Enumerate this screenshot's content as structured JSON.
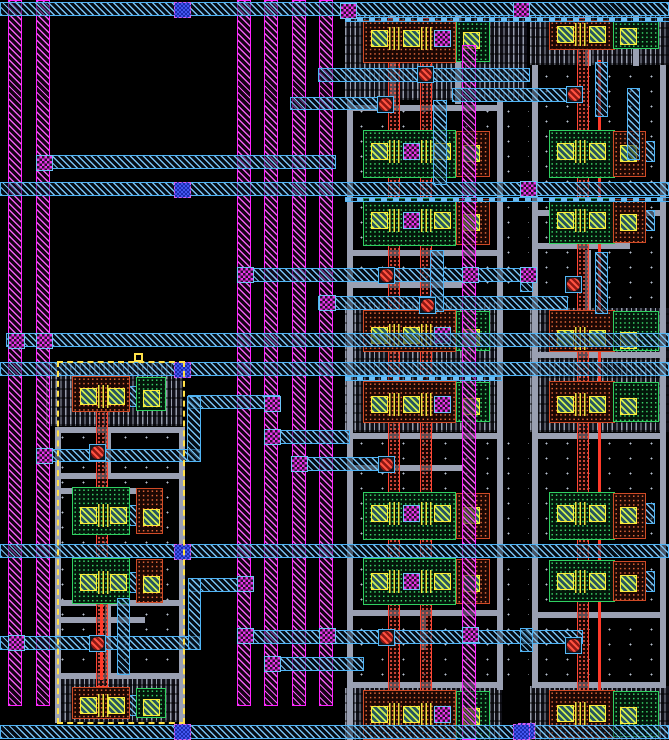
{
  "meta": {
    "width": 669,
    "height": 740,
    "description": "VLSI mask layout canvas (Magic-style), no visible text"
  },
  "palette": {
    "background": "#000000",
    "metal2": "#ff22ff",
    "metal1": "#4fb3f4",
    "via12": "#e835e8",
    "via23": "#4256ee",
    "pdiff": "#cf4a26",
    "ndiff": "#2fd061",
    "contact": "#ffe93c",
    "poly": "#ff3a2a",
    "li_wire": "#9aa0b2",
    "well_hatch": "#969cab",
    "selection": "#ffe14a"
  },
  "layout": {
    "substrate": [
      [
        345,
        100,
        184,
        82
      ],
      [
        530,
        65,
        139,
        117
      ],
      [
        345,
        196,
        184,
        106
      ],
      [
        530,
        196,
        139,
        106
      ],
      [
        345,
        432,
        184,
        112
      ],
      [
        530,
        432,
        139,
        112
      ],
      [
        345,
        558,
        184,
        130
      ],
      [
        530,
        558,
        139,
        128
      ],
      [
        46,
        426,
        137,
        118
      ],
      [
        46,
        558,
        137,
        115
      ]
    ],
    "wells": [
      [
        345,
        16,
        182,
        84
      ],
      [
        530,
        16,
        139,
        49
      ],
      [
        345,
        302,
        157,
        130
      ],
      [
        530,
        308,
        139,
        124
      ],
      [
        345,
        688,
        157,
        52
      ],
      [
        530,
        686,
        139,
        54
      ],
      [
        46,
        362,
        137,
        64
      ],
      [
        55,
        673,
        130,
        49
      ]
    ],
    "li_wires": [
      [
        347,
        100,
        6,
        640
      ],
      [
        497,
        100,
        6,
        590
      ],
      [
        347,
        105,
        156,
        6
      ],
      [
        347,
        250,
        156,
        6
      ],
      [
        353,
        282,
        110,
        6
      ],
      [
        347,
        433,
        156,
        6
      ],
      [
        353,
        465,
        110,
        6
      ],
      [
        347,
        610,
        156,
        6
      ],
      [
        347,
        682,
        156,
        6
      ],
      [
        390,
        16,
        6,
        88
      ],
      [
        455,
        16,
        6,
        88
      ],
      [
        420,
        610,
        6,
        40
      ],
      [
        532,
        65,
        6,
        620
      ],
      [
        660,
        65,
        6,
        621
      ],
      [
        532,
        210,
        134,
        6
      ],
      [
        538,
        243,
        92,
        6
      ],
      [
        532,
        352,
        134,
        6
      ],
      [
        532,
        433,
        134,
        6
      ],
      [
        532,
        612,
        134,
        6
      ],
      [
        532,
        682,
        134,
        6
      ],
      [
        585,
        16,
        6,
        50
      ],
      [
        633,
        16,
        6,
        50
      ],
      [
        585,
        250,
        6,
        60
      ],
      [
        55,
        427,
        6,
        296
      ],
      [
        179,
        427,
        6,
        296
      ],
      [
        55,
        427,
        130,
        6
      ],
      [
        55,
        473,
        124,
        6
      ],
      [
        61,
        488,
        80,
        6
      ],
      [
        55,
        600,
        130,
        6
      ],
      [
        61,
        617,
        84,
        6
      ],
      [
        55,
        673,
        130,
        6
      ],
      [
        105,
        598,
        6,
        77
      ],
      [
        105,
        433,
        6,
        42
      ]
    ],
    "poly_bars": [
      [
        388,
        18,
        12,
        688
      ],
      [
        420,
        18,
        12,
        688
      ],
      [
        577,
        18,
        12,
        688
      ],
      [
        96,
        375,
        12,
        312
      ]
    ],
    "poly_lines": [
      [
        598,
        60,
        3,
        640
      ],
      [
        100,
        560,
        3,
        120
      ]
    ],
    "m2_stripes": [
      [
        8,
        0,
        14,
        706
      ],
      [
        36,
        0,
        14,
        706
      ],
      [
        237,
        0,
        14,
        706
      ],
      [
        264,
        0,
        14,
        706
      ],
      [
        292,
        0,
        14,
        706
      ],
      [
        319,
        0,
        14,
        706
      ],
      [
        462,
        45,
        14,
        695
      ]
    ],
    "m1_h": [
      [
        0,
        2,
        669,
        14
      ],
      [
        0,
        182,
        669,
        14
      ],
      [
        0,
        362,
        669,
        14
      ],
      [
        0,
        544,
        669,
        14
      ],
      [
        0,
        725,
        669,
        14
      ],
      [
        36,
        155,
        300,
        14
      ],
      [
        318,
        68,
        212,
        14
      ],
      [
        452,
        88,
        116,
        14
      ],
      [
        290,
        97,
        90,
        13
      ],
      [
        237,
        268,
        298,
        14
      ],
      [
        318,
        296,
        250,
        14
      ],
      [
        6,
        333,
        663,
        14
      ],
      [
        36,
        449,
        164,
        13
      ],
      [
        188,
        395,
        92,
        14
      ],
      [
        264,
        430,
        86,
        14
      ],
      [
        291,
        457,
        100,
        14
      ],
      [
        188,
        578,
        64,
        14
      ],
      [
        0,
        636,
        200,
        14
      ],
      [
        237,
        630,
        346,
        14
      ],
      [
        264,
        657,
        100,
        14
      ]
    ],
    "m1_thin": [
      [
        345,
        17,
        324,
        5
      ],
      [
        345,
        197,
        324,
        5
      ],
      [
        345,
        376,
        157,
        5
      ]
    ],
    "m1_v": [
      [
        188,
        578,
        13,
        72
      ],
      [
        117,
        598,
        13,
        77
      ],
      [
        187,
        396,
        14,
        66
      ],
      [
        433,
        100,
        14,
        85
      ],
      [
        430,
        250,
        14,
        62
      ],
      [
        595,
        62,
        13,
        55
      ],
      [
        595,
        252,
        13,
        62
      ],
      [
        627,
        88,
        13,
        72
      ],
      [
        520,
        268,
        13,
        24
      ],
      [
        520,
        628,
        13,
        24
      ]
    ],
    "columns": {
      "mid": {
        "main_x": 363,
        "main_w": 93,
        "aux_x": 456,
        "aux_w_p": 34,
        "aux_w_n": 34,
        "p_contacts": [
          371,
          403
        ],
        "n_contacts": [
          371,
          434
        ],
        "via_p": 434,
        "via_n": 403,
        "aux_c": 463,
        "fingers": [
          389,
          421
        ],
        "bar_x": 367,
        "bar_w": 118
      },
      "right": {
        "main_x": 549,
        "main_w": 66,
        "aux_x": 613,
        "aux_w_p": 46,
        "aux_w_n": 33,
        "p_contacts": [
          557,
          589
        ],
        "n_contacts": [
          557,
          589
        ],
        "via_p": null,
        "via_n": null,
        "aux_c": 620,
        "fingers": [
          575
        ],
        "bar_x": 553,
        "bar_w": 102
      },
      "left": {
        "main_x": 72,
        "main_w": 58,
        "aux_x": 136,
        "aux_w_p": 30,
        "aux_w_n": 27,
        "p_contacts": [
          80,
          108
        ],
        "n_contacts": [
          80,
          110
        ],
        "via_p": null,
        "via_n": null,
        "aux_c": 143,
        "fingers": [
          98
        ],
        "bar_x": 76,
        "bar_w": 86
      }
    },
    "rows": [
      {
        "col": "mid",
        "type": "p",
        "by": 20,
        "bh": 43,
        "cy": 30
      },
      {
        "col": "mid",
        "type": "n",
        "by": 130,
        "bh": 48,
        "cy": 143
      },
      {
        "col": "mid",
        "type": "n",
        "by": 198,
        "bh": 48,
        "cy": 212
      },
      {
        "col": "mid",
        "type": "p",
        "by": 310,
        "bh": 42,
        "cy": 327
      },
      {
        "col": "mid",
        "type": "p",
        "by": 381,
        "bh": 42,
        "cy": 396
      },
      {
        "col": "mid",
        "type": "n",
        "by": 492,
        "bh": 48,
        "cy": 505
      },
      {
        "col": "mid",
        "type": "n",
        "by": 558,
        "bh": 47,
        "cy": 573
      },
      {
        "col": "mid",
        "type": "p",
        "by": 690,
        "bh": 50,
        "cy": 706
      },
      {
        "col": "right",
        "type": "p",
        "by": 20,
        "bh": 30,
        "cy": 26
      },
      {
        "col": "right",
        "type": "n",
        "by": 130,
        "bh": 48,
        "cy": 143
      },
      {
        "col": "right",
        "type": "n",
        "by": 198,
        "bh": 46,
        "cy": 212
      },
      {
        "col": "right",
        "type": "p",
        "by": 310,
        "bh": 42,
        "cy": 330
      },
      {
        "col": "right",
        "type": "p",
        "by": 381,
        "bh": 42,
        "cy": 396
      },
      {
        "col": "right",
        "type": "n",
        "by": 492,
        "bh": 48,
        "cy": 505
      },
      {
        "col": "right",
        "type": "n",
        "by": 560,
        "bh": 42,
        "cy": 573
      },
      {
        "col": "right",
        "type": "p",
        "by": 690,
        "bh": 48,
        "cy": 705
      },
      {
        "col": "left",
        "type": "p",
        "by": 376,
        "bh": 36,
        "cy": 388
      },
      {
        "col": "left",
        "type": "n",
        "by": 487,
        "bh": 48,
        "cy": 507
      },
      {
        "col": "left",
        "type": "n",
        "by": 558,
        "bh": 46,
        "cy": 574
      },
      {
        "col": "left",
        "type": "p",
        "by": 687,
        "bh": 32,
        "cy": 697
      }
    ],
    "vias_m": [
      [
        237,
        267
      ],
      [
        319,
        295
      ],
      [
        264,
        396
      ],
      [
        264,
        429
      ],
      [
        291,
        456
      ],
      [
        237,
        576
      ],
      [
        237,
        628
      ],
      [
        319,
        628
      ],
      [
        264,
        656
      ],
      [
        8,
        333
      ],
      [
        36,
        333
      ],
      [
        36,
        155
      ],
      [
        36,
        448
      ],
      [
        8,
        635
      ],
      [
        462,
        267
      ],
      [
        462,
        627
      ],
      [
        520,
        181
      ],
      [
        520,
        267
      ],
      [
        513,
        2
      ],
      [
        340,
        3
      ]
    ],
    "vias_b": [
      [
        174,
        2
      ],
      [
        174,
        182
      ],
      [
        174,
        362
      ],
      [
        174,
        544
      ],
      [
        174,
        724
      ],
      [
        518,
        723
      ],
      [
        513,
        724
      ]
    ],
    "contacts_r": [
      [
        378,
        267
      ],
      [
        419,
        297
      ],
      [
        378,
        629
      ],
      [
        378,
        456
      ],
      [
        89,
        444
      ],
      [
        89,
        635
      ],
      [
        566,
        86
      ],
      [
        565,
        276
      ],
      [
        565,
        637
      ],
      [
        377,
        96
      ],
      [
        417,
        66
      ]
    ],
    "selection": {
      "x": 57,
      "y": 361,
      "w": 128,
      "h": 363
    },
    "origin_marker": {
      "x": 134,
      "y": 353,
      "w": 9,
      "h": 9
    }
  }
}
